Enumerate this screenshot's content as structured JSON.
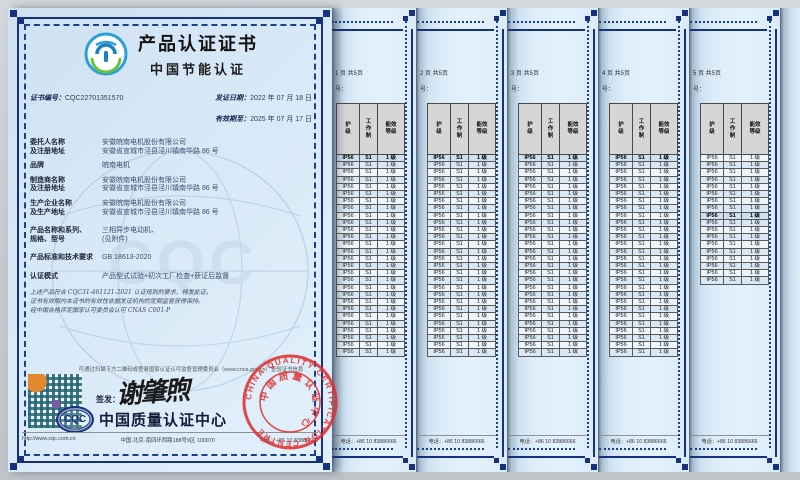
{
  "colors": {
    "border_navy": "#16317d",
    "stamp_red": "#e03030",
    "page_blue": "#d9eaf7",
    "table_header_gray": "#d6d6d6",
    "logo_blue": "#2aa0d5",
    "logo_green": "#6cbf3f"
  },
  "main": {
    "title": "产品认证证书",
    "subtitle": "中国节能认证",
    "cert_no_label": "证书编号：",
    "cert_no": "CQC22701351570",
    "issue_date_label": "发证日期：",
    "issue_date": "2022 年 07 月 18 日",
    "valid_until_label": "有效期至：",
    "valid_until": "2025 年 07 月 17 日",
    "fields": [
      {
        "label1": "委托人名称",
        "label2": "及注册地址",
        "value1": "安徽皖南电机股份有限公司",
        "value2": "安徽省宣城市泾县泾川镇南华路 86 号",
        "gap": "normal"
      },
      {
        "label1": "品牌",
        "label2": "",
        "value1": "皖南电机",
        "value2": "",
        "gap": "normal"
      },
      {
        "label1": "制造商名称",
        "label2": "及注册地址",
        "value1": "安徽皖南电机股份有限公司",
        "value2": "安徽省宣城市泾县泾川镇南华路 86 号",
        "gap": "normal"
      },
      {
        "label1": "生产企业名称",
        "label2": "及生产地址",
        "value1": "安徽皖南电机股份有限公司",
        "value2": "安徽省宣城市泾县泾川镇南华路 86 号",
        "gap": "lg"
      },
      {
        "label1": "产品名称和系列、",
        "label2": "规格、型号",
        "value1": "三相异步电动机、",
        "value2": "(见附件)",
        "gap": "lg"
      },
      {
        "label1": "产品标准和技术要求",
        "label2": "",
        "value1": "GB 18613-2020",
        "value2": "",
        "gap": "lg"
      },
      {
        "label1": "认证模式",
        "label2": "",
        "value1": "产品型式试验+初次工厂检查+获证后监督",
        "value2": "",
        "gap": "normal"
      }
    ],
    "statement": [
      "上述产品符合 CQC31-461121-2021 认证规则的要求，特发此证。",
      "证书有效期内本证书的有效性依据发证机构的定期监督获得保持。",
      "经中国合格评定国家认可委员会认可 CNAS C001-P"
    ],
    "verify_note": "可通过扫描下方二维码或登录国家认证认可监督管理委员会（www.cnca.gov.cn）查验证书信息",
    "sign_label": "签发：",
    "signer": "谢肇煦",
    "org_logo_text": "CQC",
    "org_name": "中国质量认证中心",
    "watermark_text": "CQC",
    "stamp": {
      "cn": "中国质量认证中心",
      "en": "CHINA QUALITY CERTIFICATION CENTRE"
    },
    "footer": {
      "url": "http://www.cqc.com.cn",
      "address": "中国·北京·南四环西路188号9区  100070",
      "phone": "电话：+86 10 83886666"
    }
  },
  "attachments": {
    "pages_total": 5,
    "page_texts": [
      "1 页  共5页",
      "2 页  共5页",
      "3 页  共5页",
      "4 页  共5页",
      "5 页  共5页"
    ],
    "cert_no_fragment": "号：",
    "table": {
      "headers": [
        "护级",
        "工作制",
        "能效等级"
      ],
      "row": [
        "IP56",
        "S1",
        "1 级"
      ],
      "rows_per_page": [
        28,
        28,
        28,
        28,
        18
      ],
      "bold_row_index": [
        0,
        0,
        0,
        0,
        8
      ]
    },
    "footer_phone": "电话：+86 10 83886666"
  }
}
